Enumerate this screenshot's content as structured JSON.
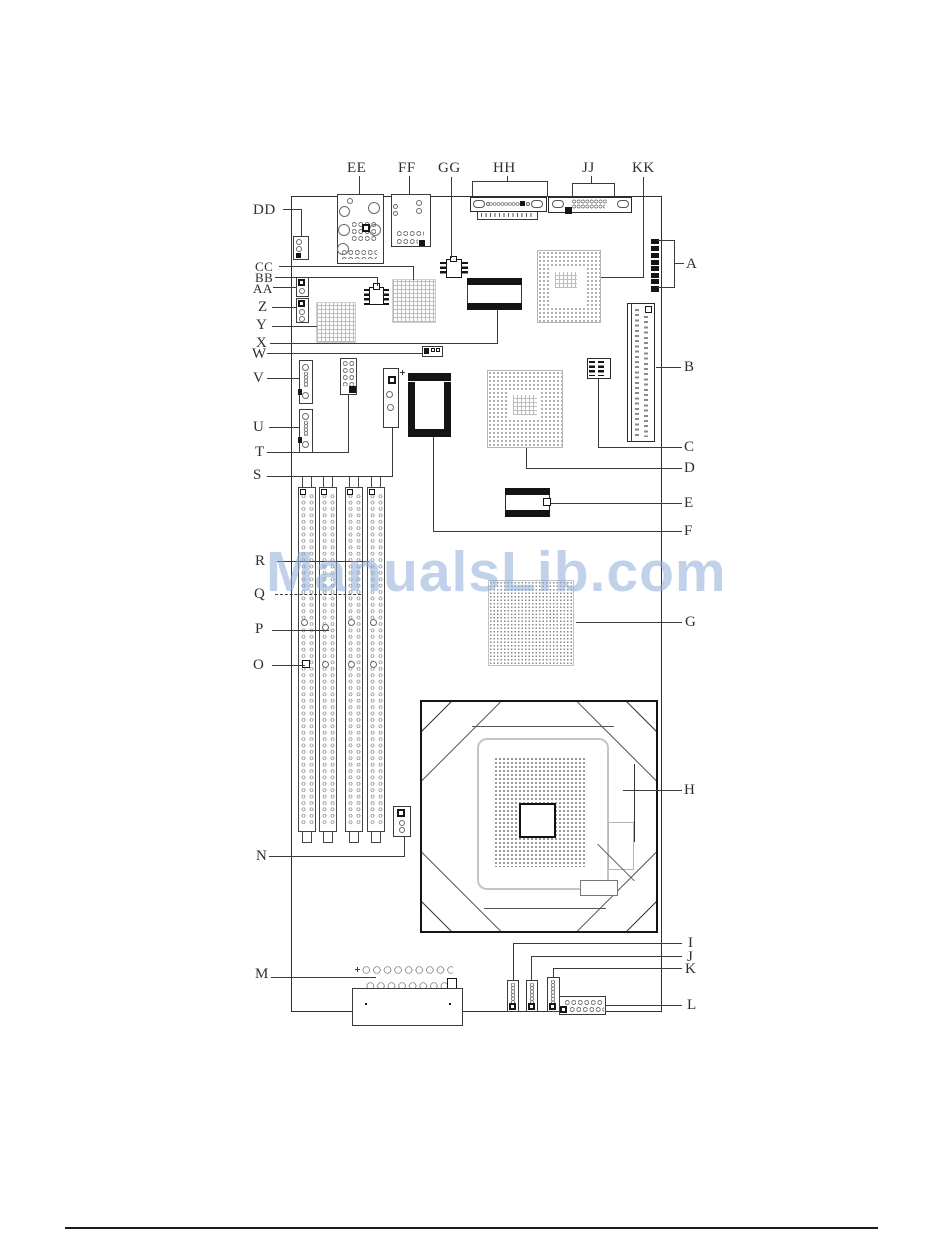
{
  "watermark": "ManualsLib.com",
  "figure": {
    "description": "Motherboard component location diagram",
    "top_labels": [
      "EE",
      "FF",
      "GG",
      "HH",
      "JJ",
      "KK"
    ],
    "left_labels": [
      "DD",
      "CC",
      "BB",
      "AA",
      "Z",
      "Y",
      "X",
      "W",
      "V",
      "U",
      "T",
      "S",
      "R",
      "Q",
      "P",
      "O",
      "N",
      "M"
    ],
    "right_labels": [
      "A",
      "B",
      "C",
      "D",
      "E",
      "F",
      "G",
      "H",
      "I",
      "J",
      "K",
      "L"
    ]
  }
}
